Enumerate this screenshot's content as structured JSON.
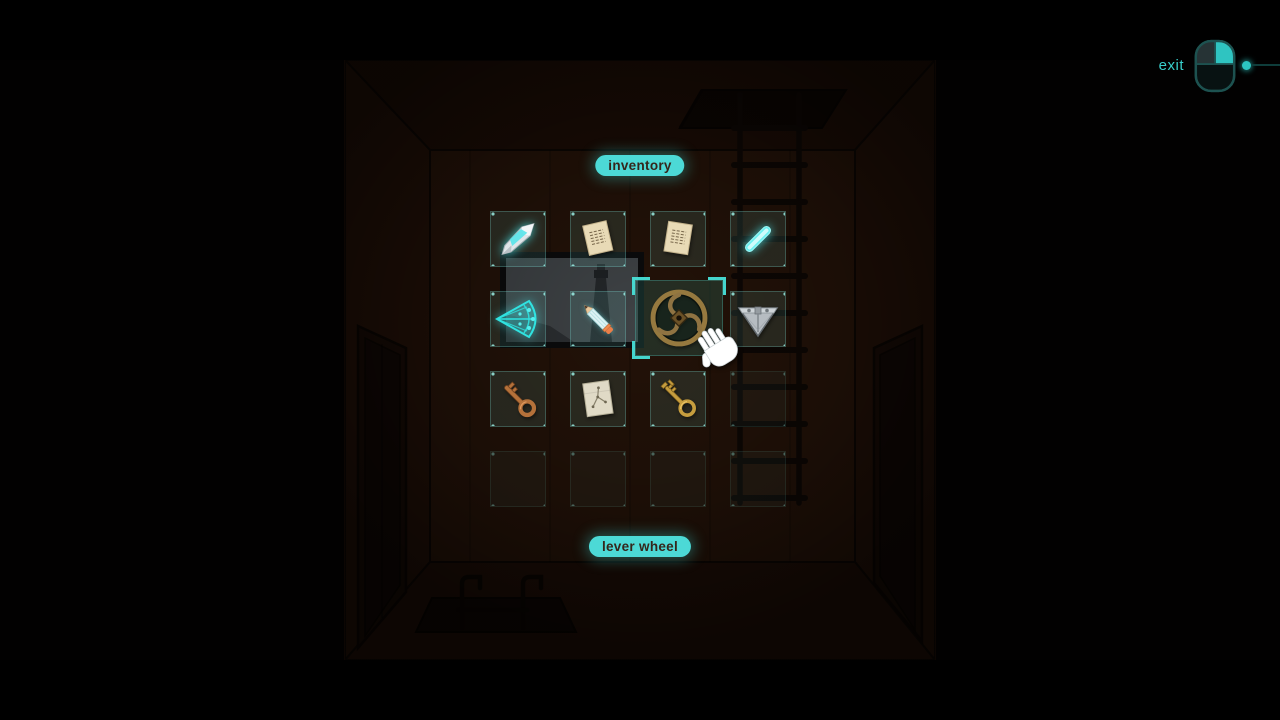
{
  "hud": {
    "exit_label": "exit"
  },
  "inventory": {
    "title_label": "inventory",
    "selected_item_label": "lever wheel",
    "grid": {
      "rows": 4,
      "cols": 4
    },
    "slots": [
      {
        "pos": "r1c1",
        "item": "crystal shard",
        "state": "filled"
      },
      {
        "pos": "r1c2",
        "item": "paper note",
        "state": "filled"
      },
      {
        "pos": "r1c3",
        "item": "paper note",
        "state": "filled"
      },
      {
        "pos": "r1c4",
        "item": "glow stick",
        "state": "filled"
      },
      {
        "pos": "r2c1",
        "item": "glowing fan",
        "state": "filled"
      },
      {
        "pos": "r2c2",
        "item": "pencil",
        "state": "filled"
      },
      {
        "pos": "r2c3",
        "item": "lever wheel",
        "state": "selected"
      },
      {
        "pos": "r2c4",
        "item": "triangle gauge",
        "state": "filled"
      },
      {
        "pos": "r3c1",
        "item": "copper key",
        "state": "filled"
      },
      {
        "pos": "r3c2",
        "item": "diagram note",
        "state": "filled"
      },
      {
        "pos": "r3c3",
        "item": "gold key",
        "state": "filled"
      },
      {
        "pos": "r3c4",
        "item": null,
        "state": "empty"
      },
      {
        "pos": "r4c1",
        "item": null,
        "state": "empty"
      },
      {
        "pos": "r4c2",
        "item": null,
        "state": "empty"
      },
      {
        "pos": "r4c3",
        "item": null,
        "state": "empty"
      },
      {
        "pos": "r4c4",
        "item": null,
        "state": "empty"
      }
    ]
  },
  "scene_objects": [
    "ladder",
    "ceiling-hatch",
    "floor-hatch",
    "left-door",
    "right-door",
    "framed-picture"
  ],
  "colors": {
    "accent": "#3fd8d3",
    "pill_bg": "#4cd9d6",
    "pill_text": "#35261c",
    "room_wall": "#231208",
    "background": "#000000"
  }
}
